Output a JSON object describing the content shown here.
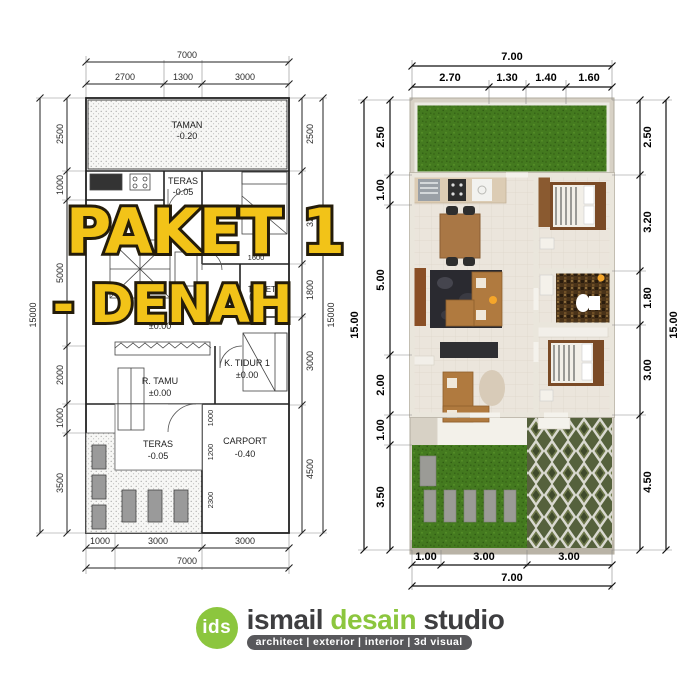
{
  "overlay": {
    "line1": "PAKET 1",
    "line2": "- DENAH",
    "color": "#F2C318",
    "outline": "#241c0a"
  },
  "left_plan": {
    "dims_top": {
      "overall": "7000",
      "segments": [
        "2700",
        "1300",
        "3000"
      ]
    },
    "dims_bottom": {
      "overall": "7000",
      "segments": [
        "1000",
        "3000",
        "3000"
      ]
    },
    "dims_left": {
      "overall": "15000",
      "segments": [
        "2500",
        "1000",
        "5000",
        "2000",
        "1000",
        "3500"
      ]
    },
    "dims_right": {
      "overall": "15000",
      "segments": [
        "2500",
        "3200",
        "1800",
        "3000",
        "4500"
      ]
    },
    "dims_interior": [
      "1600",
      "1000",
      "1200",
      "2300"
    ],
    "rooms": {
      "taman": {
        "name": "TAMAN",
        "level": "-0.20"
      },
      "teras_top": {
        "name": "TERAS",
        "level": "-0.05"
      },
      "toilet": {
        "name": "TOILET"
      },
      "center_level": "±0.00",
      "r_tamu": {
        "name": "R. TAMU",
        "level": "±0.00"
      },
      "k_tidur": {
        "name": "K. TIDUR 1",
        "level": "±0.00"
      },
      "teras_bottom": {
        "name": "TERAS",
        "level": "-0.05"
      },
      "carport": {
        "name": "CARPORT",
        "level": "-0.40"
      }
    }
  },
  "right_plan": {
    "dims_top": {
      "overall": "7.00",
      "segments": [
        "2.70",
        "1.30",
        "1.40",
        "1.60"
      ]
    },
    "dims_bottom": {
      "overall": "7.00",
      "segments": [
        "1.00",
        "3.00",
        "3.00"
      ]
    },
    "dims_left": {
      "overall": "15.00",
      "segments": [
        "2.50",
        "1.00",
        "5.00",
        "2.00",
        "1.00",
        "3.50"
      ]
    },
    "dims_right": {
      "overall": "15.00",
      "segments": [
        "2.50",
        "3.20",
        "1.80",
        "3.00",
        "4.50"
      ]
    }
  },
  "logo": {
    "badge": "ids",
    "word1": "ismail",
    "word2": "desain",
    "word3": "studio",
    "tagline": "architect | exterior | interior | 3d visual",
    "green": "#8CC63E",
    "dark": "#3E3E40",
    "bar": "#58585B"
  }
}
